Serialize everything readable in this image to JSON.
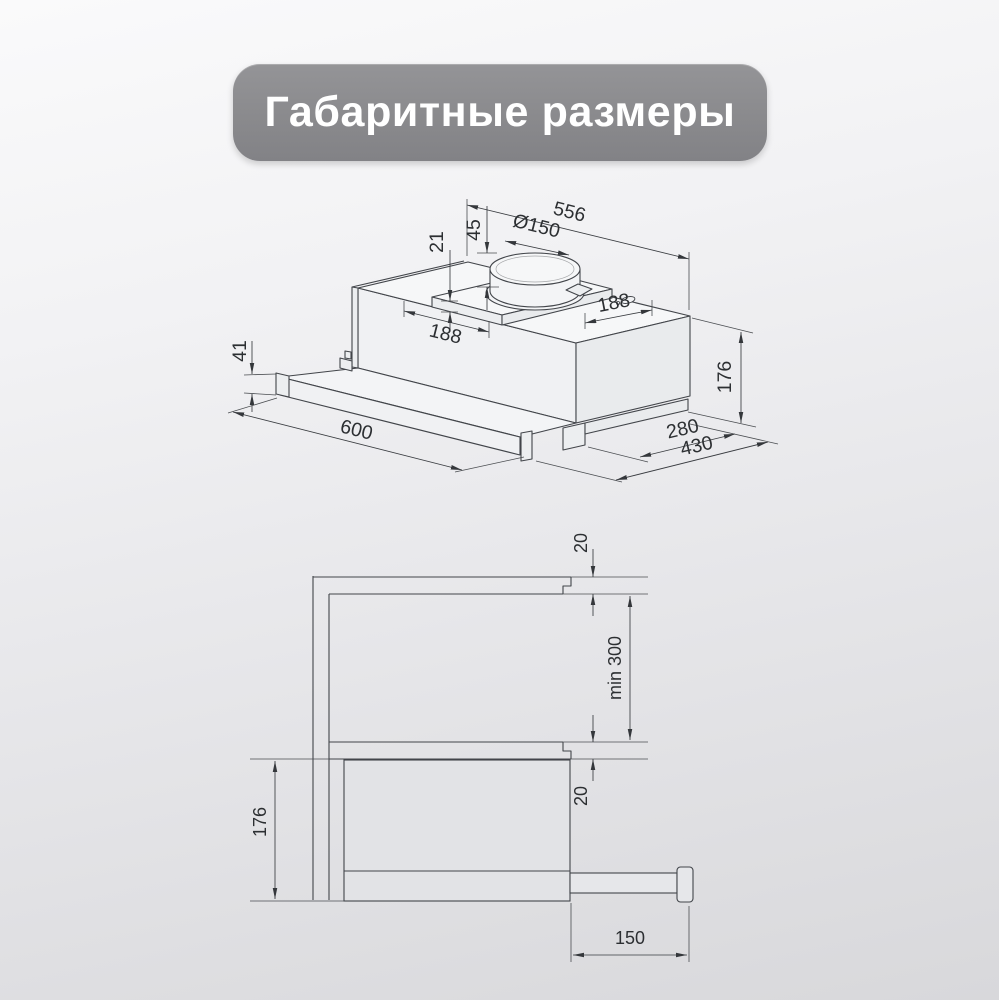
{
  "title": "Габаритные размеры",
  "iso": {
    "overall_width": "556",
    "duct_diameter": "Ø150",
    "duct_height": "45",
    "plate_height": "21",
    "offset_left": "188",
    "offset_right": "188",
    "visor_height": "41",
    "front_width": "600",
    "body_height": "176",
    "body_depth": "280",
    "overall_depth": "430"
  },
  "side": {
    "top_panel": "20",
    "min_clearance": "min 300",
    "bottom_panel": "20",
    "hood_height": "176",
    "extension": "150"
  },
  "colors": {
    "banner": "#8a8a8d",
    "line": "#42454a",
    "text": "#2c2f32",
    "background_top": "#fafafb",
    "background_bottom": "#d8d8db"
  }
}
